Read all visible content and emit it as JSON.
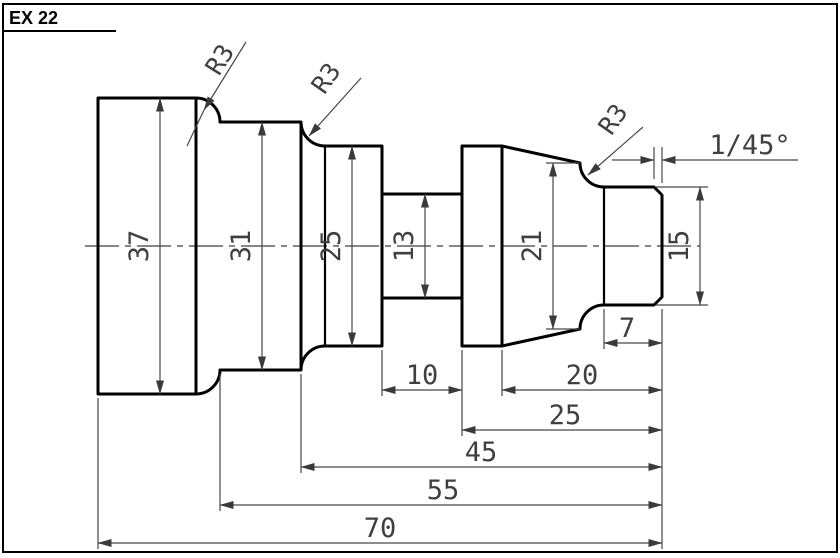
{
  "page": {
    "title": "EX 22"
  },
  "drawing": {
    "type": "technical-drawing",
    "part": "stepped shaft with groove, taper and chamfered end",
    "diameter_dims": {
      "sec1": "37",
      "sec2": "31",
      "sec3": "25",
      "groove": "13",
      "taper_end": "21",
      "end": "15"
    },
    "length_dims": {
      "groove_width": "10",
      "taper_zone": "20",
      "end_section": "7",
      "right_zone": "25",
      "to_groove": "45",
      "to_first_step": "55",
      "overall": "70"
    },
    "radius_labels": {
      "r1": "R3",
      "r2": "R3",
      "r3": "R3"
    },
    "chamfer_label": "1/45°",
    "line_colors": {
      "outline": "#000000",
      "dimension": "#474747"
    }
  }
}
